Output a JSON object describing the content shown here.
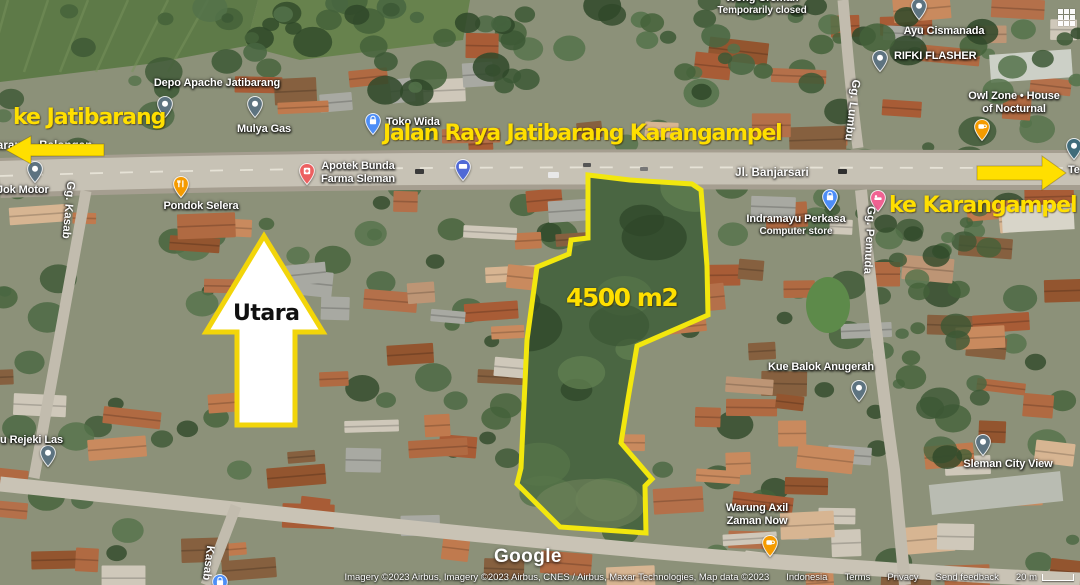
{
  "colors": {
    "annotation_yellow": "#FFDF00",
    "plot_outline_yellow": "#F2E70E",
    "north_arrow_fill": "#FFFFFF",
    "north_arrow_border": "#F2D50A",
    "label_white": "#FFFFFF"
  },
  "annotations": {
    "ke_jatibarang": "ke Jatibarang",
    "road_title": "Jalan Raya Jatibarang Karangampel",
    "ke_karangampel": "ke Karangampel",
    "north_label": "Utara",
    "plot_area_label": "4500 m2"
  },
  "places": [
    {
      "id": "wong-creman",
      "lines": [
        "Wong Creman"
      ],
      "sub": "Temporarily closed",
      "label": {
        "x": 762,
        "y": -8,
        "align": "center"
      }
    },
    {
      "id": "depo-apache-jatibarang",
      "lines": [
        "Depo Apache Jatibarang"
      ],
      "label": {
        "x": 217,
        "y": 77,
        "align": "center"
      },
      "pin": {
        "type": "generic",
        "x": 165,
        "y": 118
      }
    },
    {
      "id": "mulya-gas",
      "lines": [
        "Mulya Gas"
      ],
      "label": {
        "x": 264,
        "y": 123,
        "align": "center"
      },
      "pin": {
        "type": "generic",
        "x": 255,
        "y": 118
      }
    },
    {
      "id": "toko-wida",
      "lines": [
        "Toko Wida"
      ],
      "label": {
        "x": 386,
        "y": 116,
        "align": "left"
      },
      "pin": {
        "type": "shopping",
        "x": 373,
        "y": 135
      }
    },
    {
      "id": "apotek-bunda-farma-sleman",
      "lines": [
        "Apotek Bunda",
        "Farma Sleman"
      ],
      "label": {
        "x": 358,
        "y": 160,
        "align": "center"
      },
      "pin": {
        "type": "pharmacy",
        "x": 307,
        "y": 185
      }
    },
    {
      "id": "pondok-selera",
      "lines": [
        "Pondok Selera"
      ],
      "label": {
        "x": 201,
        "y": 200,
        "align": "center"
      },
      "pin": {
        "type": "food",
        "x": 181,
        "y": 198
      }
    },
    {
      "id": "jok-motor",
      "lines": [
        "Jok Motor"
      ],
      "label": {
        "x": -3,
        "y": 184,
        "align": "left"
      },
      "pin": {
        "type": "generic",
        "x": 35,
        "y": 183
      }
    },
    {
      "id": "rejeki-las",
      "lines": [
        "u Rejeki Las"
      ],
      "label": {
        "x": 0,
        "y": 434,
        "align": "left"
      },
      "pin": {
        "type": "generic",
        "x": 48,
        "y": 467
      }
    },
    {
      "id": "ayu-cismanada",
      "lines": [
        "Ayu Cismanada"
      ],
      "label": {
        "x": 944,
        "y": 25,
        "align": "center"
      },
      "pin": {
        "type": "generic",
        "x": 919,
        "y": 20
      }
    },
    {
      "id": "rifki-flasher",
      "lines": [
        "RIFKI FLASHER"
      ],
      "label": {
        "x": 894,
        "y": 50,
        "align": "left"
      },
      "pin": {
        "type": "generic",
        "x": 880,
        "y": 72
      }
    },
    {
      "id": "owl-zone-house-of-nocturnal",
      "lines": [
        "Owl Zone • House",
        "of Nocturnal"
      ],
      "label": {
        "x": 1014,
        "y": 90,
        "align": "center"
      },
      "pin": {
        "type": "coffee",
        "x": 982,
        "y": 141
      }
    },
    {
      "id": "indramayu-perkasa",
      "lines": [
        "Indramayu Perkasa"
      ],
      "sub": "Computer store",
      "label": {
        "x": 796,
        "y": 213,
        "align": "center"
      },
      "pin": {
        "type": "shopping",
        "x": 830,
        "y": 211
      }
    },
    {
      "id": "kue-balok-anugerah",
      "lines": [
        "Kue Balok Anugerah"
      ],
      "label": {
        "x": 768,
        "y": 361,
        "align": "left"
      },
      "pin": {
        "type": "generic",
        "x": 859,
        "y": 402
      }
    },
    {
      "id": "sleman-city-view",
      "lines": [
        "Sleman City View"
      ],
      "label": {
        "x": 1008,
        "y": 458,
        "align": "center"
      },
      "pin": {
        "type": "generic",
        "x": 983,
        "y": 456
      }
    },
    {
      "id": "warung-axil-zaman-now",
      "lines": [
        "Warung Axil",
        "Zaman Now"
      ],
      "label": {
        "x": 757,
        "y": 502,
        "align": "center"
      },
      "pin": {
        "type": "coffee",
        "x": 770,
        "y": 557
      }
    },
    {
      "id": "te-partial",
      "lines": [
        "Te"
      ],
      "label": {
        "x": 1068,
        "y": 164,
        "align": "left"
      },
      "pin": {
        "type": "dark",
        "x": 1074,
        "y": 160
      }
    },
    {
      "id": "route-badge",
      "pin": {
        "type": "badge",
        "x": 463,
        "y": 181
      }
    },
    {
      "id": "lodging",
      "pin": {
        "type": "lodging",
        "x": 878,
        "y": 212
      }
    },
    {
      "id": "partial-pin-bottom",
      "pin": {
        "type": "shopping",
        "x": 220,
        "y": 596
      }
    }
  ],
  "road_labels": [
    {
      "text": "Jatibarang - Balongan",
      "x": 31,
      "y": 146,
      "rotate": 0
    },
    {
      "text": "Jl. Banjarsari",
      "x": 772,
      "y": 173,
      "rotate": 0
    },
    {
      "text": "Gg. Kasab",
      "x": 68,
      "y": 210,
      "rotate": 95
    },
    {
      "text": "Gg. Pemuda",
      "x": 869,
      "y": 240,
      "rotate": 93
    },
    {
      "text": "Gg. Lumbu",
      "x": 852,
      "y": 110,
      "rotate": 97
    },
    {
      "text": "Kasab",
      "x": 208,
      "y": 563,
      "rotate": 97
    }
  ],
  "footer": {
    "logo": "Google",
    "attribution": "Imagery ©2023 Airbus, Imagery ©2023 Airbus, CNES / Airbus, Maxar Technologies, Map data ©2023",
    "links": [
      "Indonesia",
      "Terms",
      "Privacy",
      "Send feedback"
    ],
    "scale_label": "20 m"
  }
}
